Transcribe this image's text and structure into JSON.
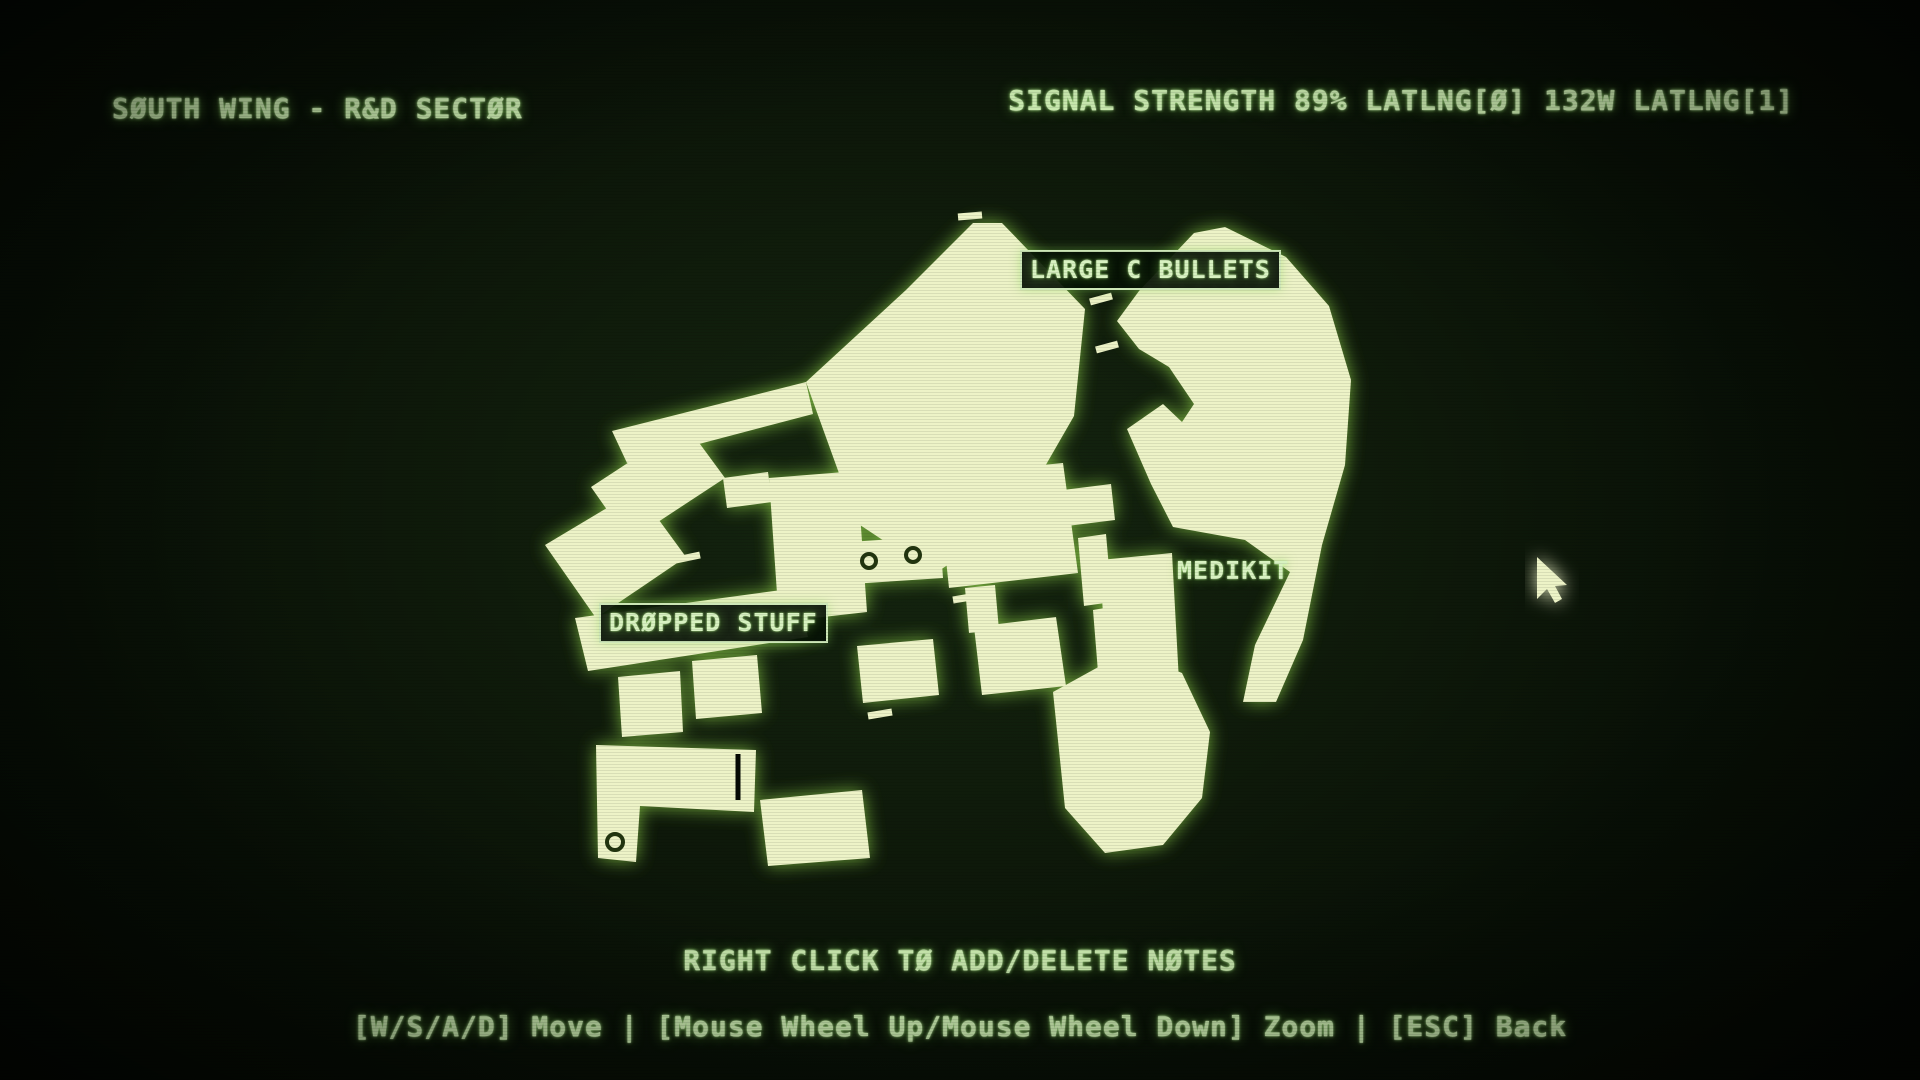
{
  "header": {
    "title": "SØUTH WING - R&D SECTØR",
    "signal_status": "SIGNAL STRENGTH 89% LATLNG[Ø] 132W LATLNG[1]"
  },
  "footer": {
    "note_hint": "RIGHT CLICK TØ ADD/DELETE NØTES",
    "controls_hint": "[W/S/A/D] Move | [Mouse Wheel Up/Mouse Wheel Down] Zoom | [ESC] Back"
  },
  "colors": {
    "room_fill": "#edf3c7",
    "room_glow": "#85c344",
    "hud_text": "#c9e9ae",
    "marker_ring": "#22350f",
    "background_center": "#152610",
    "background_edge": "#040903"
  },
  "map": {
    "labels": [
      {
        "id": "large-c-bullets",
        "text": "LARGE C BULLETS",
        "x": 1020,
        "y": 250,
        "boxed": true
      },
      {
        "id": "medikit",
        "text": "MEDIKIT",
        "x": 1177,
        "y": 558,
        "boxed": false
      },
      {
        "id": "dropped-stuff",
        "text": "DRØPPED STUFF",
        "x": 599,
        "y": 603,
        "boxed": true
      }
    ],
    "rooms": [
      {
        "name": "hall-nw",
        "points": "973,223 1002,223 1085,309 1074,416 1013,522 934,574 857,523 806,382 906,290"
      },
      {
        "name": "hall-ne",
        "points": "1139,291 1194,233 1225,227 1286,257 1329,306 1351,380 1345,465 1322,545 1303,640 1276,702 1243,702 1255,645 1290,572 1245,540 1173,527 1151,484 1127,429 1163,404 1182,422 1194,404 1169,367 1139,349 1117,321"
      },
      {
        "name": "corridor-west",
        "points": "806,382 813,414 627,463 612,431"
      },
      {
        "name": "room-w1",
        "points": "591,487 686,425 725,478 629,541"
      },
      {
        "name": "room-w2",
        "points": "545,545 637,490 686,557 596,618"
      },
      {
        "name": "corridor-sw",
        "points": "575,618 796,588 808,637 588,671"
      },
      {
        "name": "room-sw1",
        "points": "618,677 680,671 683,732 622,737"
      },
      {
        "name": "room-sw2",
        "points": "692,661 757,655 762,713 696,719"
      },
      {
        "name": "corridor-s",
        "points": "596,745 756,750 754,812 640,806 636,862 598,858"
      },
      {
        "name": "room-s",
        "points": "760,800 862,790 870,858 768,866"
      },
      {
        "name": "room-c1",
        "points": "769,478 857,471 867,612 779,622"
      },
      {
        "name": "room-c2",
        "points": "849,542 940,536 943,578 851,584"
      },
      {
        "name": "hall-c",
        "points": "937,475 1063,463 1078,573 949,588"
      },
      {
        "name": "bridge-e",
        "points": "1063,490 1111,484 1115,520 1067,526"
      },
      {
        "name": "bridge-c",
        "points": "723,478 768,472 772,502 727,508"
      },
      {
        "name": "neck-c",
        "points": "965,588 995,585 999,630 969,633"
      },
      {
        "name": "room-c3",
        "points": "974,627 1056,617 1066,686 982,695"
      },
      {
        "name": "room-c4",
        "points": "857,646 933,639 939,695 863,703"
      },
      {
        "name": "room-e1",
        "points": "1100,560 1172,553 1180,700 1108,707"
      },
      {
        "name": "corridor-e",
        "points": "1078,538 1106,534 1112,602 1084,606"
      },
      {
        "name": "stem-se",
        "points": "1093,610 1122,605 1127,667 1098,672"
      },
      {
        "name": "hall-se",
        "points": "1053,692 1102,665 1148,659 1182,673 1210,732 1202,798 1163,845 1105,853 1065,808"
      }
    ],
    "door_dashes": [
      [
        958,
        217,
        982,
        215
      ],
      [
        1090,
        302,
        1112,
        296
      ],
      [
        1096,
        350,
        1118,
        344
      ],
      [
        1000,
        536,
        1024,
        530
      ],
      [
        1032,
        550,
        1056,
        544
      ],
      [
        640,
        452,
        662,
        446
      ],
      [
        676,
        560,
        700,
        555
      ],
      [
        812,
        612,
        836,
        608
      ],
      [
        1124,
        610,
        1124,
        640
      ],
      [
        600,
        748,
        600,
        774
      ],
      [
        868,
        716,
        892,
        712
      ],
      [
        953,
        600,
        977,
        596
      ]
    ],
    "dark_slits": [
      [
        738,
        754,
        738,
        800
      ]
    ],
    "rings": [
      {
        "cx": 869,
        "cy": 561,
        "r": 7
      },
      {
        "cx": 913,
        "cy": 555,
        "r": 7
      },
      {
        "cx": 615,
        "cy": 842,
        "r": 8
      }
    ],
    "cursor_points": "1537,557 1537,599 1547,589 1555,603 1562,599 1555,586 1567,585"
  }
}
